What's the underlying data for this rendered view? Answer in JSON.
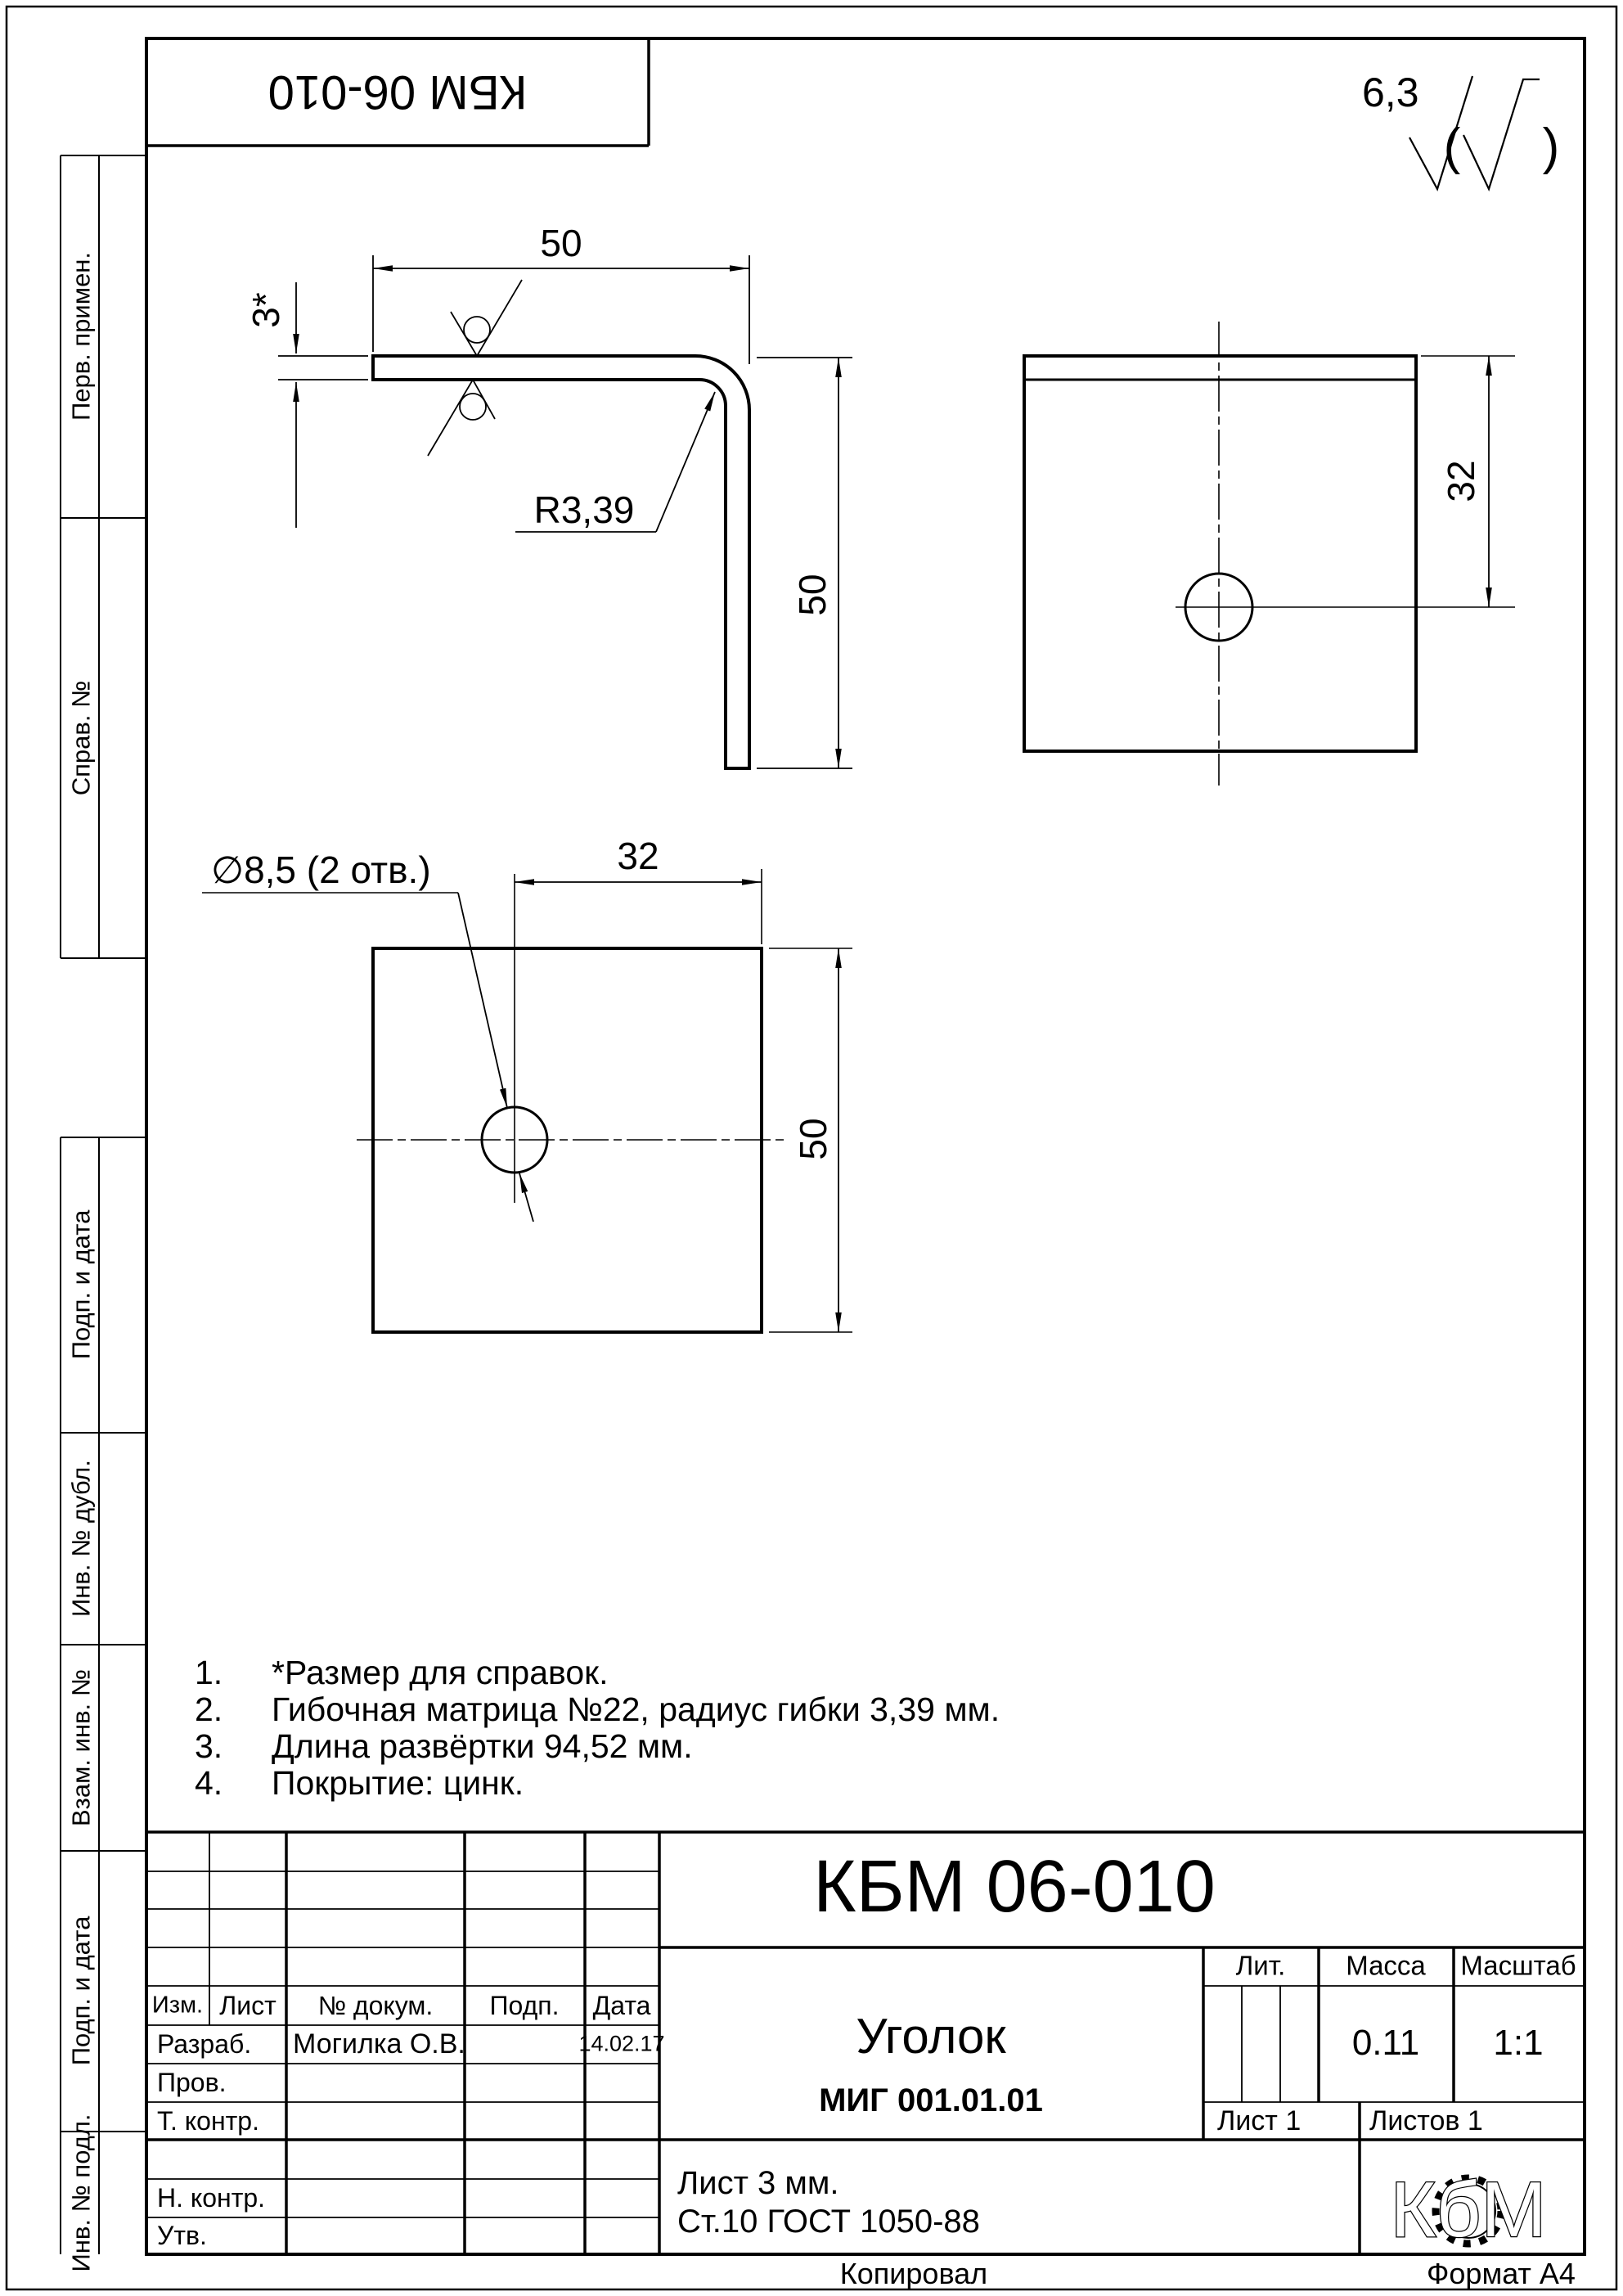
{
  "page": {
    "copied_label": "Копировал",
    "format_label": "Формат А4"
  },
  "stamp": {
    "designation": "КБМ 06-010"
  },
  "roughness": {
    "value": "6,3",
    "paren_open": "(",
    "paren_close": ")"
  },
  "margin": {
    "labels": [
      "Перв. примен.",
      "Справ. №",
      "Подп. и дата",
      "Инв. № дубл.",
      "Взам. инв. №",
      "Подп. и дата",
      "Инв. № подл."
    ]
  },
  "views": {
    "side": {
      "width": "50",
      "thickness": "3*",
      "radius": "R3,39",
      "height": "50"
    },
    "face": {
      "offset": "32"
    },
    "flat": {
      "callout": "∅8,5 (2 отв.)",
      "offset": "32",
      "height": "50"
    }
  },
  "notes": {
    "items": [
      {
        "num": "1.",
        "text": "*Размер для справок."
      },
      {
        "num": "2.",
        "text": "Гибочная матрица №22, радиус гибки 3,39 мм."
      },
      {
        "num": "3.",
        "text": "Длина развёртки 94,52 мм."
      },
      {
        "num": "4.",
        "text": "Покрытие: цинк."
      }
    ]
  },
  "title_block": {
    "designation": "КБМ 06-010",
    "part_name": "Уголок",
    "doc_code": "МИГ 001.01.01",
    "header": {
      "izm": "Изм.",
      "list": "Лист",
      "doc": "№ докум.",
      "podp": "Подп.",
      "date": "Дата"
    },
    "roles": {
      "developer_label": "Разраб.",
      "developer_name": "Могилка О.В.",
      "developer_date": "14.02.17",
      "checker_label": "Пров.",
      "tcontrol_label": "Т. контр.",
      "ncontrol_label": "Н. контр.",
      "approver_label": "Утв."
    },
    "lit_label": "Лит.",
    "mass_label": "Масса",
    "scale_label": "Масштаб",
    "mass_value": "0.11",
    "scale_value": "1:1",
    "sheet_label": "Лист 1",
    "sheets_label": "Листов 1",
    "material_line1": "Лист 3 мм.",
    "material_line2": "Ст.10 ГОСТ 1050-88",
    "logo_text": "КбМ"
  }
}
